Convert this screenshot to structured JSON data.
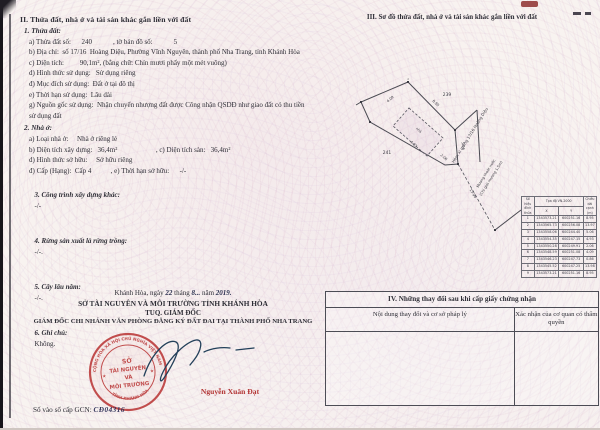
{
  "colors": {
    "stamp_red": "#bd4040",
    "ink_blue": "#23405a",
    "name_red": "#b23434"
  },
  "sectionII": {
    "title": "II. Thửa đất, nhà ở và tài sản khác gắn liền với đất",
    "item1_heading": "1. Thửa đất:",
    "item1_lines": [
      "a) Thửa đất số:      240            , tờ bản đồ số:            5",
      "b) Địa chỉ:  số 17/16  Hoàng Diệu, Phường Vĩnh Nguyên, thành phố Nha Trang, tỉnh Khánh Hòa",
      "c) Diện tích:         90,1m², (bằng chữ: Chín mươi phẩy một mét vuông)",
      "d) Hình thức sử dụng:   Sử dụng riêng",
      "đ) Mục đích sử dụng:  Đất ở tại đô thị",
      "e) Thời hạn sử dụng:  Lâu dài",
      "g) Nguồn gốc sử dụng:  Nhận chuyển nhượng đất được Công nhận QSDĐ như giao đất có thu tiền sử dụng đất"
    ],
    "item2_heading": "2. Nhà ở:",
    "item2_lines": [
      "a) Loại nhà ở:     Nhà ở riêng lẻ",
      "b) Diện tích xây dựng:   36,4m²                      , c) Diện tích sàn:   36,4m²",
      "d) Hình thức sở hữu:     Sở hữu riêng",
      "đ) Cấp (Hạng):  Cấp 4           , e) Thời hạn sở hữu:      -/-"
    ],
    "item3_label": "3. Công trình xây dựng khác:",
    "item3_value": "-/-",
    "item4_label": "4. Rừng sản xuất là rừng trồng:",
    "item4_value": "-/-.",
    "item5_label": "5. Cây lâu năm:",
    "item5_value": "-/-.",
    "item6_label": "6. Ghi chú:",
    "item6_value": "Không."
  },
  "signature": {
    "date_prefix": "Khánh Hòa, ngày",
    "date_day": "22",
    "date_mid1": "tháng",
    "date_month": "8...",
    "date_mid2": "năm",
    "date_year": "2019.",
    "org": "SỞ TÀI NGUYÊN VÀ MÔI TRƯỜNG TỈNH KHÁNH HÒA",
    "tuq": "TUQ. GIÁM ĐỐC",
    "role": "GIÁM ĐỐC CHI NHÁNH VĂN PHÒNG ĐĂNG KÝ ĐẤT ĐAI TẠI THÀNH PHỐ NHA TRANG",
    "signer": "Nguyễn Xuân Đạt",
    "gcn_label": "Số vào sổ cấp GCN:",
    "gcn_number": "CĐ04316"
  },
  "stamp": {
    "ring_top": "CỘNG HÒA XÃ HỘI CHỦ NGHĨA VIỆT NAM",
    "ring_bottom": "TỈNH KHÁNH HÒA",
    "center1": "SỞ",
    "center2": "TÀI NGUYÊN",
    "center3": "VÀ",
    "center4": "MÔI TRƯỜNG",
    "star": "★"
  },
  "sectionIII": {
    "title": "III. Sơ đồ thửa đất, nhà ở và tài sản khác gắn liền với đất",
    "diagram": {
      "vertex_top": "1",
      "neighbor_top": "239",
      "neighbor_left": "241",
      "house_label": "nhà",
      "dim_left": "4.09",
      "dim_top": "8.95",
      "dim_bottom": "4.93",
      "dim_corner": "2.06",
      "dim_right": "5.06",
      "dim_road": "13.98",
      "road_label": "Hẻm xi măng 17/16 Hoàng Diệu",
      "note_line1": "Mương thoát nước",
      "note_line2": "(Chỉ giới mương 1,5m)"
    },
    "coord_table": {
      "col1": "Số hiệu đỉnh thửa",
      "col2": "Tọa độ VN-2000",
      "colX": "X",
      "colY": "Y",
      "col3": "Chiều dài cạnh (m)",
      "rows": [
        [
          "1",
          "1343573.21",
          "600251.16",
          "8.95"
        ],
        [
          "2",
          "1343565.73",
          "600256.08",
          "13.97"
        ],
        [
          "3",
          "1343558.06",
          "600244.40",
          "5.06"
        ],
        [
          "4",
          "1343554.35",
          "600247.15",
          "4.93"
        ],
        [
          "5",
          "1343550.28",
          "600249.91",
          "2.06"
        ],
        [
          "6",
          "1343548.59",
          "600251.08",
          "4.09"
        ],
        [
          "7",
          "1343546.23",
          "600247.73",
          "0.86"
        ],
        [
          "8",
          "1343545.52",
          "600247.25",
          "13.98"
        ],
        [
          "9",
          "1343573.21",
          "600251.16",
          "8.95"
        ]
      ]
    }
  },
  "sectionIV": {
    "title": "IV. Những thay đổi sau khi cấp giấy chứng nhận",
    "col1": "Nội dung thay đổi và cơ sở pháp lý",
    "col2": "Xác nhận của cơ quan có thẩm quyền"
  }
}
